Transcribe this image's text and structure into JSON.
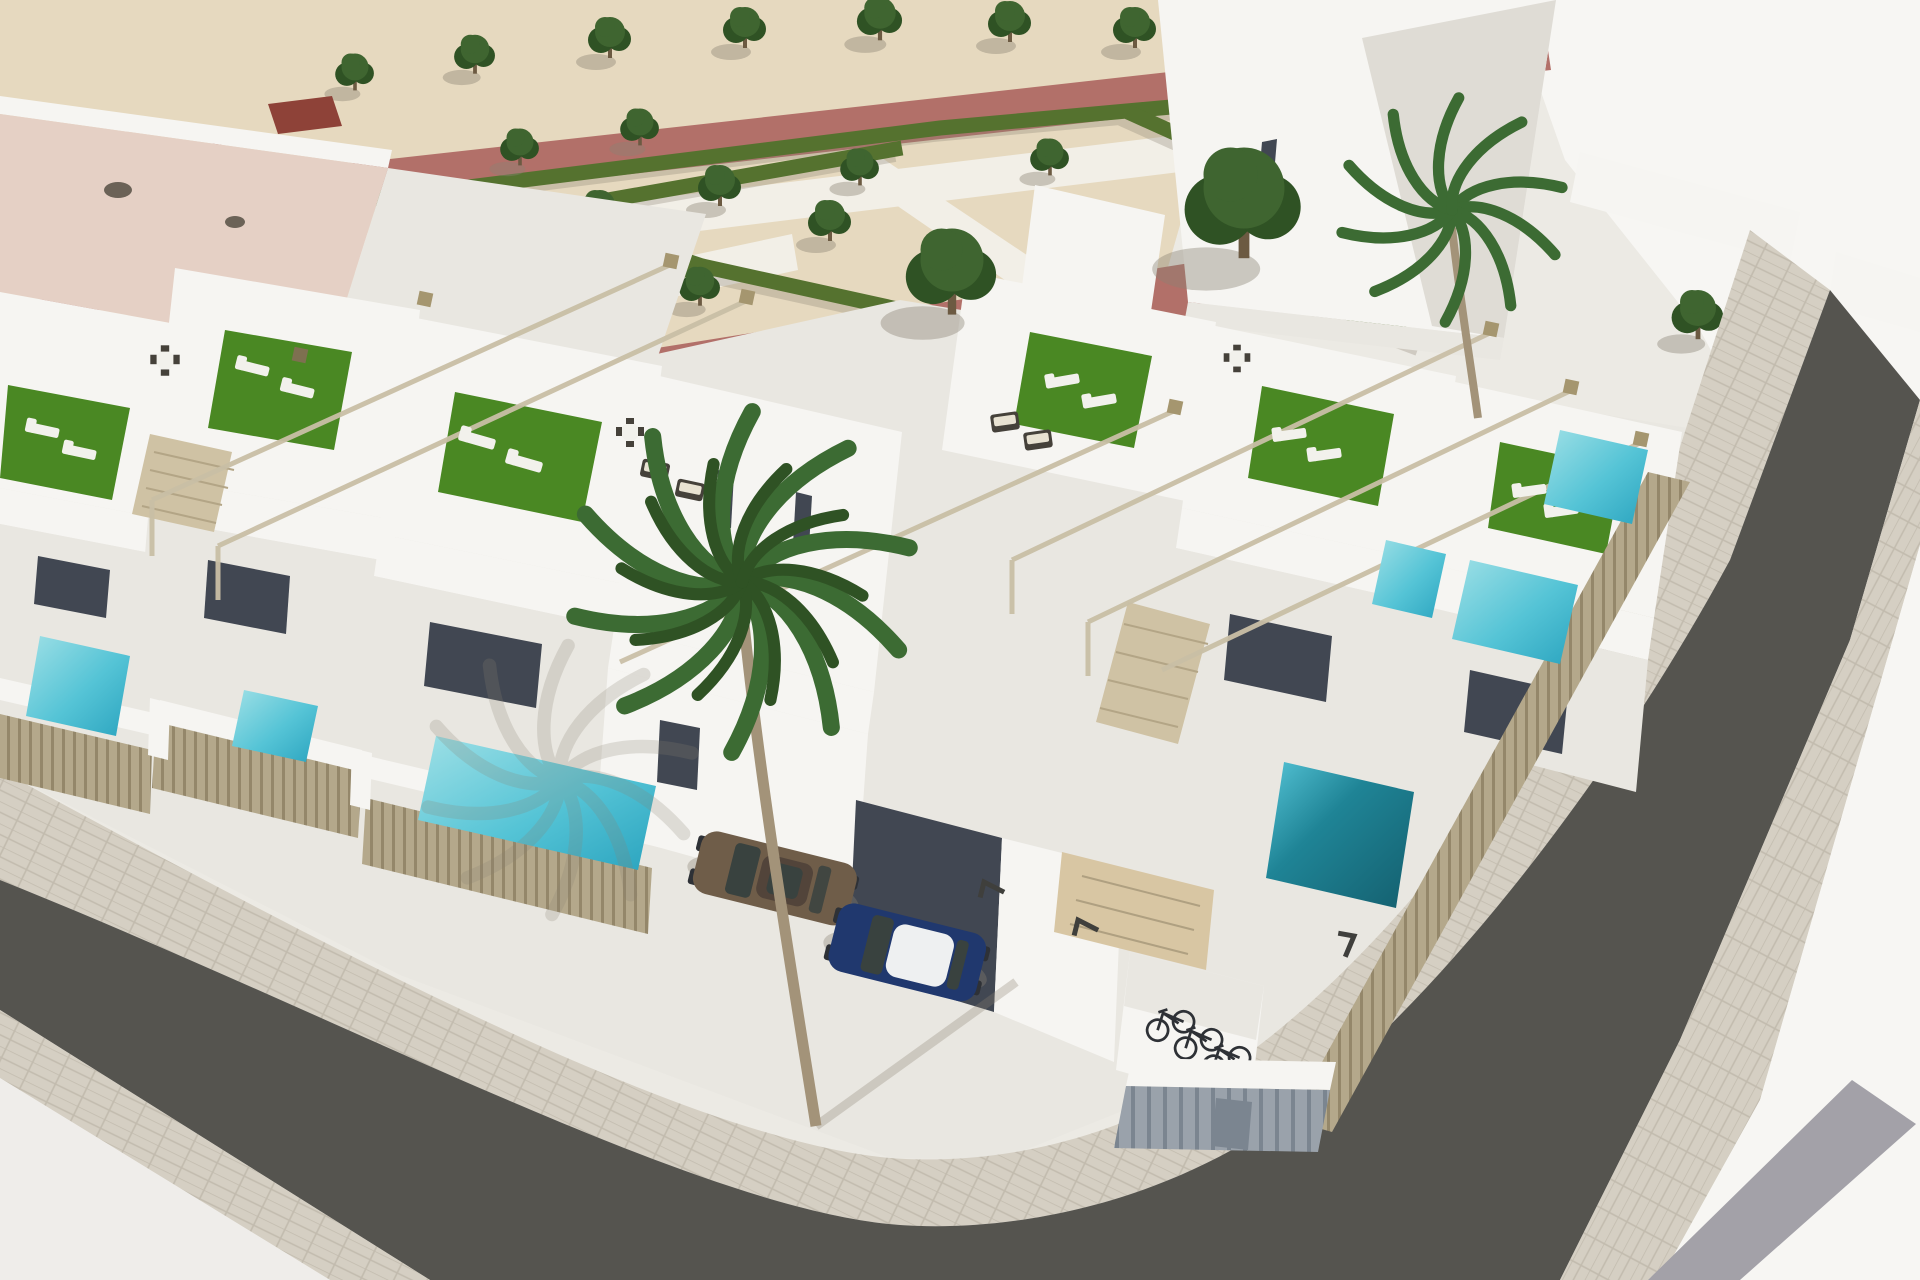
{
  "scene": {
    "type": "3d-architectural-render",
    "view": "aerial corner perspective of a residential development",
    "development": "rows of white modern townhouses with roof terraces, private plunge pools, slatted privacy fences and street-level parking",
    "landscape": {
      "park": "formal garden with zigzag clipped hedges and rows of trees on sand-colored gravel",
      "paths": [
        "white walkways",
        "terracotta-red promenade",
        "paver sidewalks"
      ]
    },
    "vehicles": {
      "cars": [
        {
          "label": "brown hatchback"
        },
        {
          "label": "dark-blue car with white roof"
        }
      ],
      "bicycles": 3
    },
    "pools": {
      "count": 7,
      "water_colors": [
        "turquoise",
        "deep teal"
      ]
    },
    "palm_trees": 2,
    "streets": 2,
    "furniture": [
      "sun loungers",
      "dark wicker lounge sets",
      "outdoor dining tables"
    ]
  },
  "colors": {
    "base": "#eceae4",
    "bright": "#f7f6f3",
    "sand": "#e6d9bf",
    "walk": "#f2efe7",
    "path_red": "#b27069",
    "tile_red": "#8e4238",
    "hedge": "#55722f",
    "tree": "#3f6530",
    "tree_dark": "#2f5224",
    "trunk": "#6c5a42",
    "shadow": "#8a8272",
    "wall_white": "#f6f5f2",
    "wall_light": "#e9e7e1",
    "wall_light2": "#dfdcd5",
    "wall_shadow": "#bdb9b0",
    "glass": "#414752",
    "roof_pink": "#e5d0c5",
    "turf": "#4a8823",
    "pool_light": "#9fe0e6",
    "pool_mid": "#55c4d6",
    "pool_deep": "#2ba4bf",
    "pool_teal": "#1f8496",
    "pool_teal_deep": "#145f6e",
    "street": "#55544f",
    "street_dark": "#4c4b47",
    "sidewalk": "#d5cfc3",
    "paver_line": "#c2bbae",
    "plaza": "#efedea",
    "plaza_stripe": "#a3a1a8",
    "fence": "#b4a88b",
    "fence_dark": "#94876a",
    "pergola": "#c9bfa6",
    "capital": "#a5966f",
    "capital_dark": "#7e7050",
    "stair": "#cfc2a4",
    "stair_line": "#b3a586",
    "lounger": "#f2f1ec",
    "wicker": "#45413a",
    "cushion": "#e8e2d2",
    "car_brown": "#6f5d49",
    "car_brown_dark": "#52443a",
    "car_blue": "#20386e",
    "car_roof": "#eef0f1",
    "car_glass": "#39423f",
    "bike": "#2e3136",
    "shed": "#9aa2ab",
    "shed_dark": "#7b8590",
    "garage_door": "#d8c6a3",
    "palm_green": "#3c6b33",
    "vent": "#6b6257"
  }
}
